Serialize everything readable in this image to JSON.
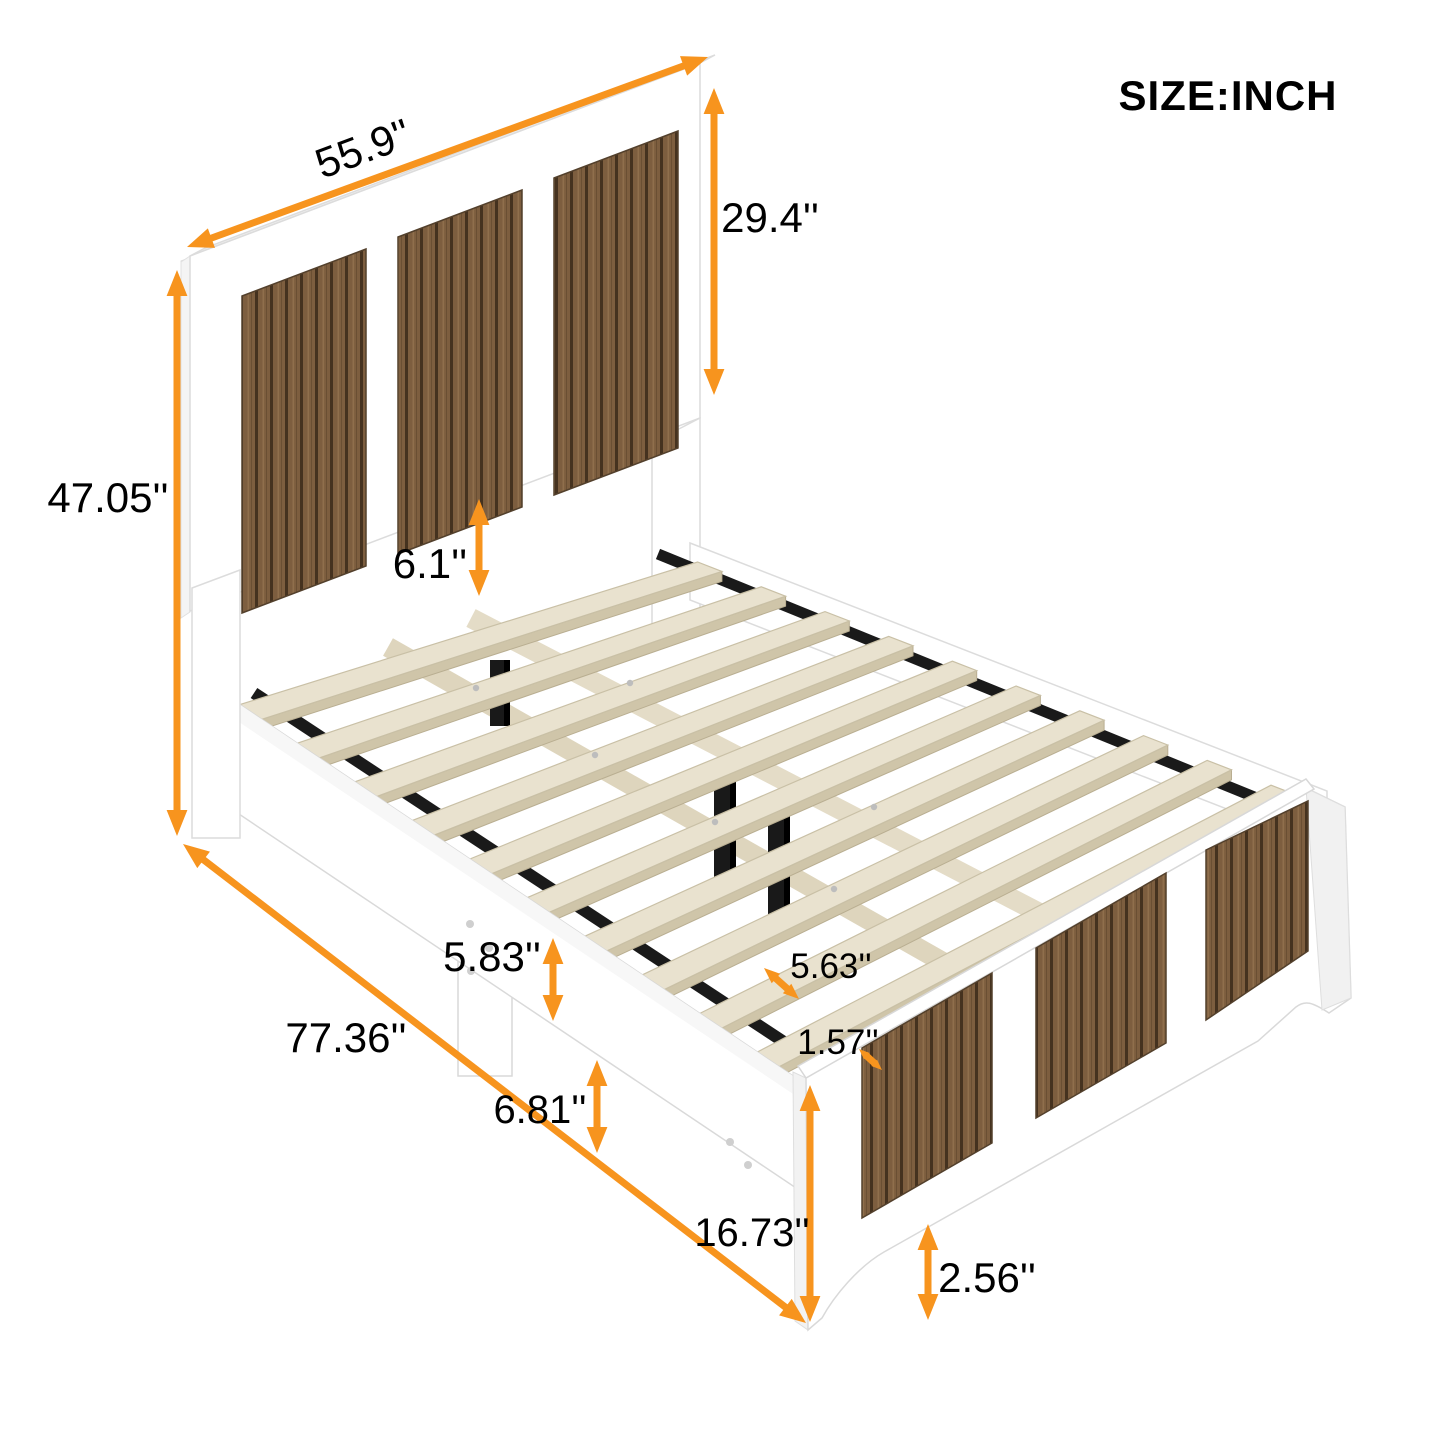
{
  "header": {
    "unit_label": "SIZE:INCH"
  },
  "colors": {
    "accent": "#f7941e",
    "panel_wood": "#7d5e3f",
    "panel_wood_groove": "#45321f",
    "slat_wood": "#e9e2cf",
    "metal": "#1a1a1a"
  },
  "dims": {
    "headboard_width": "55.9''",
    "headboard_upper_height": "29.4''",
    "headboard_total_height": "47.05''",
    "headboard_to_slat_gap": "6.1''",
    "side_rail_height": "5.83''",
    "bed_length": "77.36''",
    "slat_gap": "5.63''",
    "slat_width": "1.57''",
    "under_bed_clearance": "6.81''",
    "footboard_height": "16.73''",
    "foot_leg_height": "2.56''"
  }
}
